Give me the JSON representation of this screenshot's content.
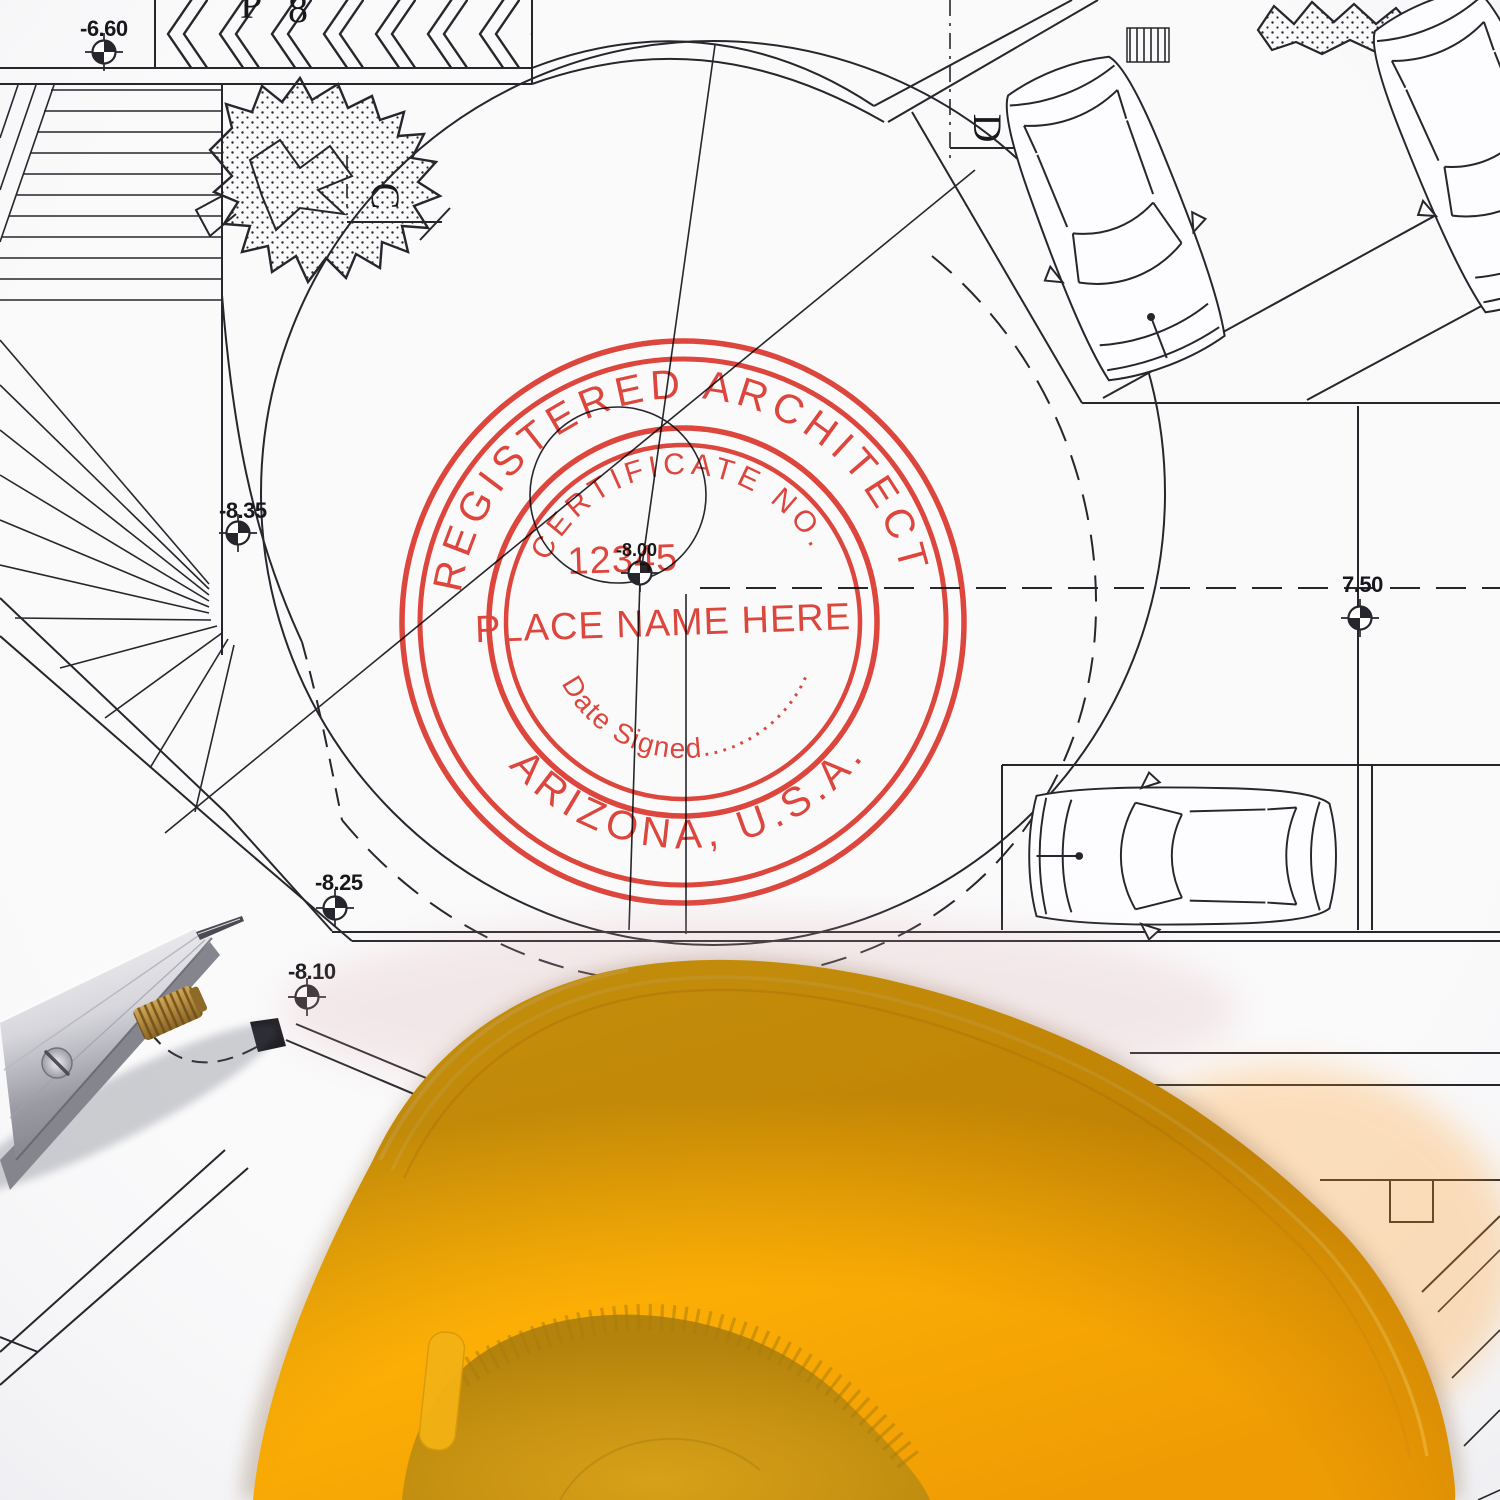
{
  "stamp": {
    "arc_top": "REGISTERED ARCHITECT",
    "arc_inner_top": "CERTIFICATE NO.",
    "certificate_number": "12345",
    "name_line": "PLACE NAME HERE",
    "date_line": "Date Signed...............",
    "arc_bottom": "ARIZONA, U.S.A.",
    "ink_color": "#e0392e"
  },
  "blueprint": {
    "line_color": "#26262c",
    "elevation_labels": [
      {
        "text": "-6.60"
      },
      {
        "text": "-8.35"
      },
      {
        "text": "-8.25"
      },
      {
        "text": "-8.10"
      },
      {
        "text": "-8.00"
      },
      {
        "text": "7.50"
      }
    ],
    "section_labels": [
      {
        "text": "C"
      },
      {
        "text": "D"
      }
    ],
    "partial_top_labels": [
      {
        "text": "P"
      },
      {
        "text": "8"
      }
    ]
  },
  "hardhat": {
    "shell_color": "#ffb606",
    "inner_color": "#c8920e"
  },
  "tool": {
    "name": "drafting divider",
    "metal_color": "#c9c9cf",
    "brass_color": "#a97f35"
  }
}
